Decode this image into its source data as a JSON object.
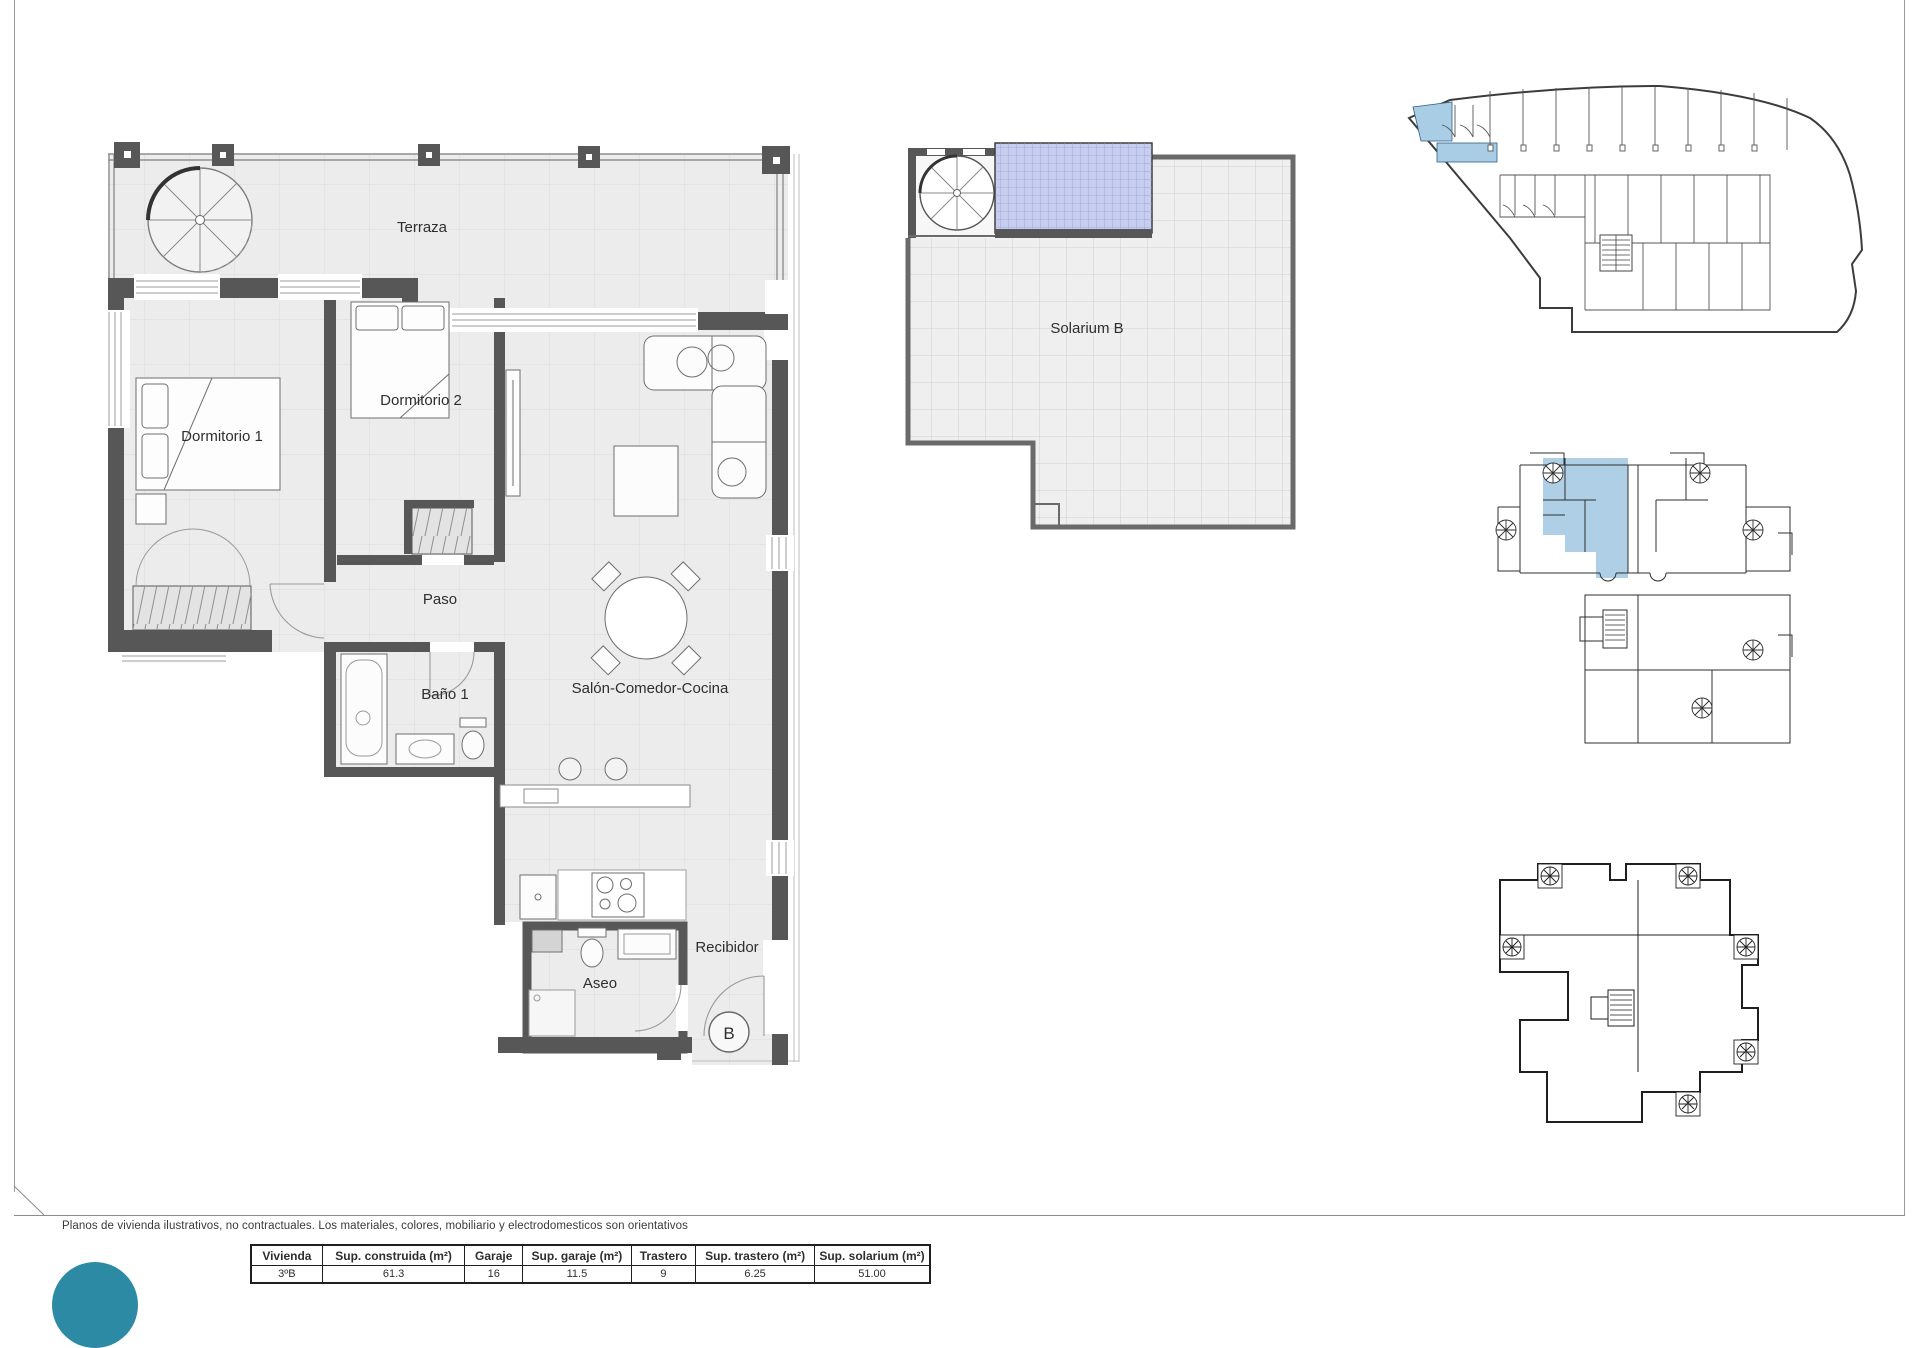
{
  "document": {
    "disclaimer": "Planos de vivienda ilustrativos, no contractuales. Los materiales, colores, mobiliario y electrodomesticos son orientativos"
  },
  "main_plan": {
    "labels": {
      "terraza": "Terraza",
      "dormitorio1": "Dormitorio 1",
      "dormitorio2": "Dormitorio 2",
      "paso": "Paso",
      "bano1": "Baño 1",
      "salon": "Salón-Comedor-Cocina",
      "aseo": "Aseo",
      "recibidor": "Recibidor",
      "unit_letter": "B"
    }
  },
  "solarium_plan": {
    "label": "Solarium B"
  },
  "summary_table": {
    "headers": [
      "Vivienda",
      "Sup. construida (m²)",
      "Garaje",
      "Sup. garaje (m²)",
      "Trastero",
      "Sup. trastero (m²)",
      "Sup. solarium (m²)"
    ],
    "row": [
      "3ºB",
      "61.3",
      "16",
      "11.5",
      "9",
      "6.25",
      "51.00"
    ]
  },
  "colors": {
    "wall_gray": "#575757",
    "floor_gray": "#ececec",
    "highlight_blue": "#aecfe6",
    "pergola_blue": "#c7cdee",
    "logo_teal": "#2d8aa5"
  }
}
